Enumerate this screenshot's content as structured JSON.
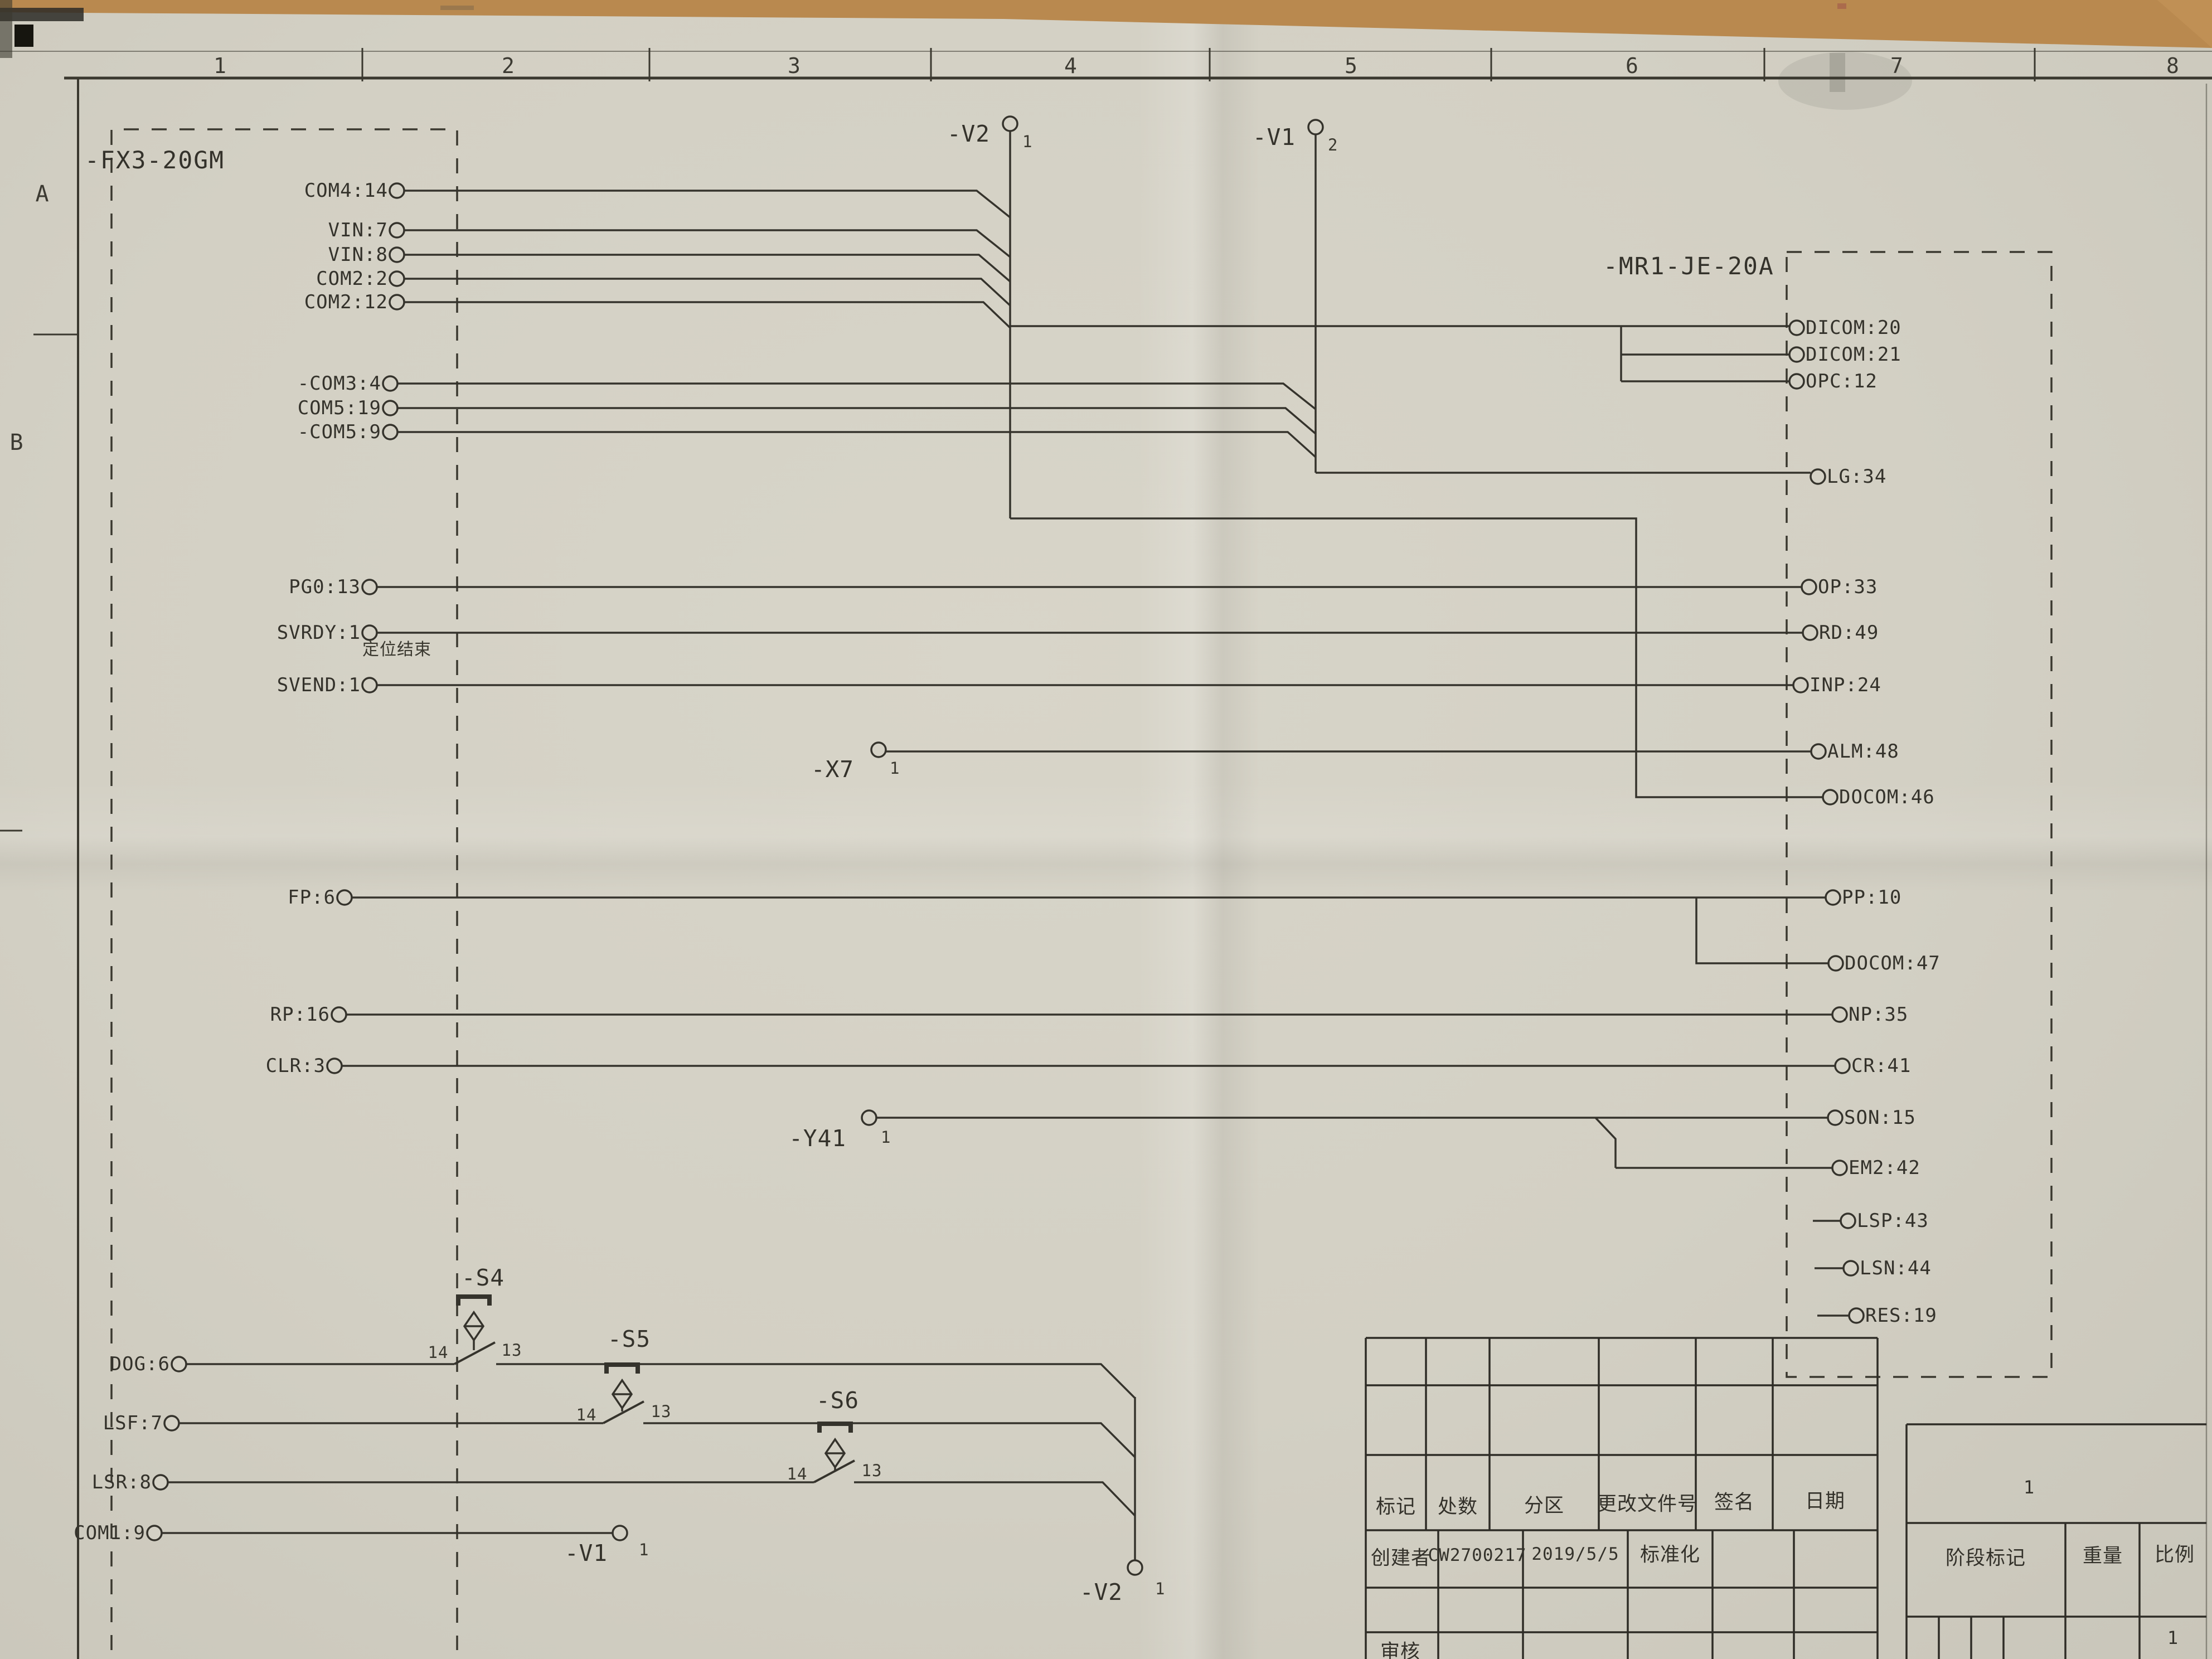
{
  "ruler": {
    "numbers": [
      "1",
      "2",
      "3",
      "4",
      "5",
      "6",
      "7",
      "8"
    ]
  },
  "rows": {
    "letters": [
      "A",
      "B"
    ]
  },
  "fx3": {
    "label": "-FX3-20GM",
    "terminals": [
      "COM4:14",
      "VIN:7",
      "VIN:8",
      "COM2:2",
      "COM2:12",
      "-COM3:4",
      "COM5:19",
      "-COM5:9",
      "PG0:13",
      "SVRDY:1",
      "SVEND:1",
      "FP:6",
      "RP:16",
      "CLR:3",
      "DOG:6",
      "LSF:7",
      "LSR:8",
      "COM1:9"
    ]
  },
  "mr1": {
    "label": "-MR1-JE-20A",
    "terminals": [
      "DICOM:20",
      "DICOM:21",
      "OPC:12",
      "LG:34",
      "OP:33",
      "RD:49",
      "INP:24",
      "ALM:48",
      "DOCOM:46",
      "PP:10",
      "DOCOM:47",
      "NP:35",
      "CR:41",
      "SON:15",
      "EM2:42",
      "LSP:43",
      "LSN:44",
      "RES:19"
    ]
  },
  "connectors": {
    "v2_top": {
      "label": "-V2",
      "pin": "1"
    },
    "v1_top": {
      "label": "-V1",
      "pin": "2"
    },
    "x7": {
      "label": "-X7",
      "pin": "1"
    },
    "y41": {
      "label": "-Y41",
      "pin": "1"
    },
    "v1_bottom": {
      "label": "-V1",
      "pin": "1"
    },
    "v2_bottom": {
      "label": "-V2",
      "pin": "1"
    }
  },
  "switches": {
    "s4": {
      "label": "-S4",
      "pin_left": "14",
      "pin_right": "13"
    },
    "s5": {
      "label": "-S5",
      "pin_left": "14",
      "pin_right": "13"
    },
    "s6": {
      "label": "-S6",
      "pin_left": "14",
      "pin_right": "13"
    }
  },
  "notes": {
    "svend": "定位结束"
  },
  "title": {
    "revision_headers": [
      "标记",
      "处数",
      "分区",
      "更改文件号",
      "签名",
      "日期"
    ],
    "creator_label": "创建者",
    "creator_value": "CW2700217",
    "date": "2019/5/5",
    "standard": "标准化",
    "stage": "阶段标记",
    "weight": "重量",
    "scale": "比例",
    "sheet_no": "1",
    "scale_value": "1",
    "audit": "审核"
  }
}
